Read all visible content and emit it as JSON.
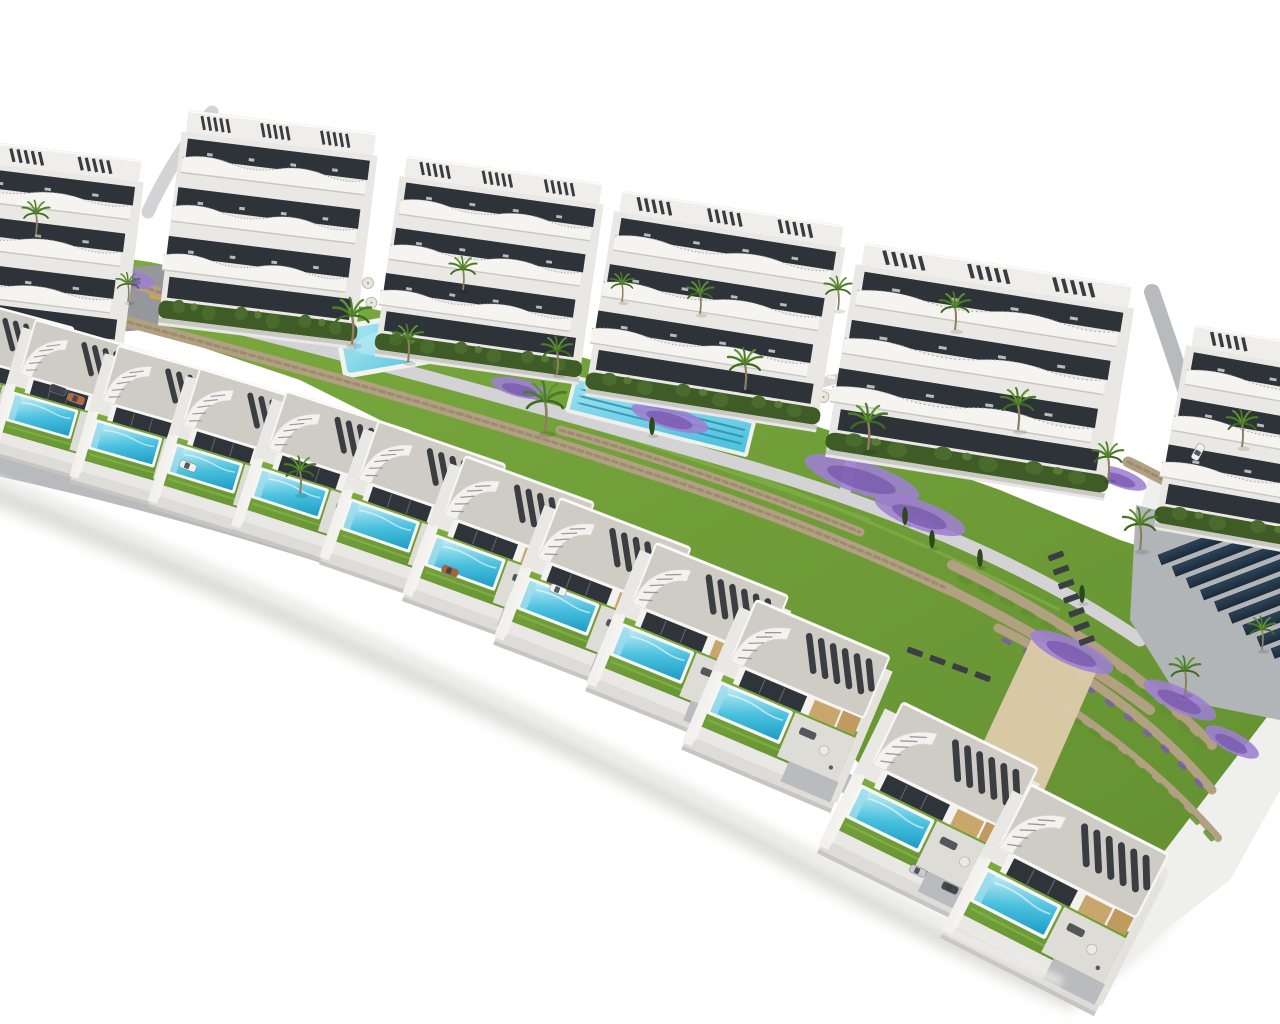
{
  "meta": {
    "title": "Aerial 3D architectural render of a Mediterranean residential development",
    "description": "Bird's-eye render on a pure white background: a curved hillside complex with six wavy-balcony apartment blocks along the top, a landscaped amenity strip with two communal pools, palm trees, bougainvillea beds and stone retaining walls, a diagonal cascade of twelve modern white villas each with a private turquoise pool, parked cars along an internal road, and a dark-blue solar panel array with terraced stone walls at the lower right.",
    "image_type": "architectural-render",
    "background": "white"
  },
  "scene": {
    "palette": {
      "bg": "#ffffff",
      "building_white": "#f3f2ee",
      "building_body": "#e9e8e4",
      "band_shadow": "#c8c7c3",
      "glass_dark": "#2e333a",
      "roof_gray": "#cfccc5",
      "slat_dark": "#3a3e43",
      "beige_wall": "#c9a66c",
      "beige_side": "#c09a5e",
      "hedge_green": "#3f5c26",
      "lawn_green": "#7cab3f",
      "lawn_dark": "#638f31",
      "palm_green": "#4c7c28",
      "trunk_brown": "#8f7f5e",
      "pool_light": "#c9f0f6",
      "pool_mid": "#49c0de",
      "pool_deep": "#1e9cc6",
      "big_pool_light": "#aee8f2",
      "big_pool_deep": "#54c2dd",
      "stone_tan": "#b2a082",
      "stone_dark": "#8a7a5f",
      "plaza_gray": "#95979b",
      "road_gray": "#b8babd",
      "path_light": "#d3d3d5",
      "terrace_gray": "#dedcd6",
      "purple": "#7b5ab0",
      "purple_light": "#9d7fd0",
      "solar_navy": "#2e4459",
      "solar_dark": "#1b2b3c",
      "sand": "#dccbaa",
      "slope_white": "#eff0ed",
      "shadow_soft": "#d2d2cf",
      "car_white": "#eef0f2"
    },
    "counts": {
      "apartment_blocks": 6,
      "apartment_floors_per_block": 4,
      "villas": 12,
      "private_pools": 12,
      "communal_pools": 2,
      "solar_panel_rows": 9,
      "palm_trees": 20,
      "parked_cars": 8
    },
    "apartments": [
      [
        -85,
        128,
        7,
        0.8,
        0.72
      ],
      [
        178,
        104,
        7,
        0.7,
        0.75
      ],
      [
        396,
        150,
        8,
        0.73,
        0.7
      ],
      [
        610,
        184,
        9,
        0.83,
        0.72
      ],
      [
        850,
        236,
        9,
        1.0,
        0.75
      ],
      [
        1182,
        318,
        10,
        0.88,
        0.72
      ]
    ],
    "villas": [
      [
        -35,
        390,
        15,
        0.9
      ],
      [
        42,
        415,
        16,
        0.92
      ],
      [
        125,
        443,
        16,
        0.94
      ],
      [
        205,
        468,
        17,
        0.96
      ],
      [
        290,
        493,
        18,
        0.98
      ],
      [
        380,
        525,
        19,
        1.0
      ],
      [
        465,
        562,
        20,
        1.02
      ],
      [
        558,
        606,
        21,
        1.04
      ],
      [
        652,
        653,
        22,
        1.06
      ],
      [
        750,
        712,
        23,
        1.08
      ],
      [
        890,
        818,
        26,
        1.12
      ],
      [
        1016,
        903,
        27,
        1.15
      ]
    ],
    "villa_pool_anchor": [
      47,
      110
    ],
    "palms": [
      [
        352,
        344,
        1.1
      ],
      [
        408,
        362,
        0.9
      ],
      [
        463,
        290,
        0.8
      ],
      [
        545,
        432,
        1.2
      ],
      [
        557,
        374,
        0.9
      ],
      [
        622,
        302,
        0.7
      ],
      [
        700,
        314,
        0.8
      ],
      [
        745,
        390,
        1.0
      ],
      [
        838,
        310,
        0.8
      ],
      [
        868,
        450,
        1.1
      ],
      [
        955,
        330,
        0.9
      ],
      [
        1018,
        430,
        1.0
      ],
      [
        1108,
        480,
        0.9
      ],
      [
        1140,
        550,
        1.0
      ],
      [
        1242,
        447,
        0.9
      ],
      [
        1262,
        650,
        0.8
      ],
      [
        1185,
        694,
        0.9
      ],
      [
        300,
        494,
        0.9
      ],
      [
        128,
        302,
        0.7
      ],
      [
        36,
        234,
        0.8
      ]
    ],
    "cypresses": [
      [
        905,
        524
      ],
      [
        932,
        547
      ],
      [
        652,
        434
      ],
      [
        1082,
        602
      ],
      [
        980,
        566
      ]
    ],
    "flower_beds": [
      [
        215,
        298,
        55,
        13,
        10
      ],
      [
        448,
        325,
        40,
        11,
        12
      ],
      [
        520,
        388,
        30,
        9,
        14
      ],
      [
        670,
        418,
        40,
        11,
        16
      ],
      [
        862,
        478,
        60,
        16,
        18
      ],
      [
        920,
        515,
        48,
        14,
        20
      ],
      [
        1072,
        652,
        45,
        13,
        24
      ],
      [
        1180,
        700,
        40,
        12,
        26
      ],
      [
        1232,
        742,
        30,
        10,
        28
      ],
      [
        120,
        278,
        35,
        10,
        8
      ],
      [
        20,
        262,
        30,
        9,
        6
      ],
      [
        60,
        268,
        40,
        10,
        7
      ],
      [
        1120,
        478,
        28,
        9,
        20
      ]
    ],
    "cars": [
      [
        58,
        390,
        20,
        "#3f434a"
      ],
      [
        76,
        399,
        20,
        "#b46a3e"
      ],
      [
        188,
        466,
        21,
        "#eef0f2"
      ],
      [
        450,
        571,
        22,
        "#a8623c"
      ],
      [
        558,
        590,
        22,
        "#f0f1f3"
      ],
      [
        918,
        871,
        24,
        "#c9cbce"
      ],
      [
        950,
        888,
        25,
        "#43474e"
      ],
      [
        1198,
        452,
        -62,
        "#eef0f2"
      ]
    ],
    "lounger_clusters": [
      [
        250,
        283,
        -10,
        3,
        4,
        24,
        17,
        "lounger"
      ],
      [
        368,
        283,
        -10,
        2,
        4,
        26,
        20,
        "parasol"
      ],
      [
        250,
        312,
        -10,
        1,
        2,
        22,
        0,
        "parasol"
      ],
      [
        788,
        368,
        12,
        2,
        3,
        22,
        15,
        "lounger"
      ],
      [
        800,
        392,
        12,
        1,
        2,
        24,
        0,
        "parasol"
      ],
      [
        4,
        298,
        8,
        2,
        2,
        20,
        14,
        "lounger"
      ],
      [
        1056,
        556,
        -20,
        7,
        1,
        0,
        15,
        "dark"
      ],
      [
        915,
        652,
        20,
        1,
        4,
        24,
        0,
        "dark"
      ]
    ],
    "solar_array": {
      "x": 1158,
      "y": 555,
      "rot": -21,
      "rows": 9,
      "row_w": 170,
      "row_h": 10.5,
      "stagger_x": 9,
      "gap_y": 16
    }
  }
}
